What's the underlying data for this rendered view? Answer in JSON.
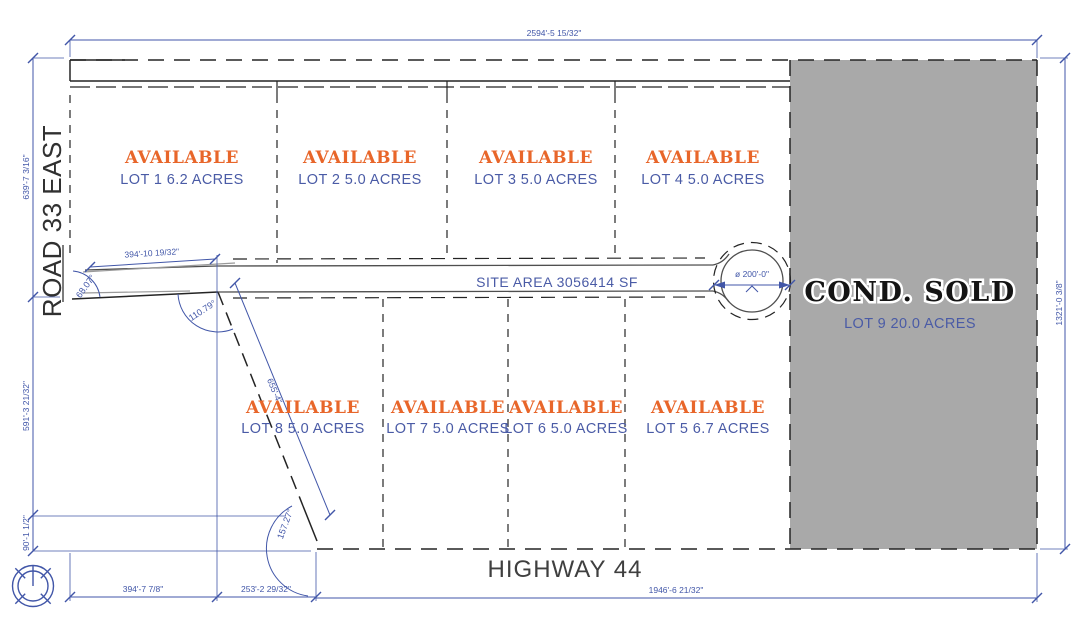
{
  "plan": {
    "site_area_label": "SITE AREA 3056414 SF",
    "roads": {
      "west": "ROAD 33 EAST",
      "south": "HIGHWAY 44"
    },
    "colors": {
      "dimension_blue": "#4156a8",
      "available_orange": "#e8662a",
      "lot_text_blue": "#4a5ba6",
      "sold_gray": "#a9a9a9",
      "line_black": "#242424"
    },
    "lots": [
      {
        "id": "lot-1",
        "status": "AVAILABLE",
        "label": "LOT 1 6.2 ACRES"
      },
      {
        "id": "lot-2",
        "status": "AVAILABLE",
        "label": "LOT 2 5.0 ACRES"
      },
      {
        "id": "lot-3",
        "status": "AVAILABLE",
        "label": "LOT 3 5.0 ACRES"
      },
      {
        "id": "lot-4",
        "status": "AVAILABLE",
        "label": "LOT 4 5.0 ACRES"
      },
      {
        "id": "lot-5",
        "status": "AVAILABLE",
        "label": "LOT 5 6.7 ACRES"
      },
      {
        "id": "lot-6",
        "status": "AVAILABLE",
        "label": "LOT 6 5.0 ACRES"
      },
      {
        "id": "lot-7",
        "status": "AVAILABLE",
        "label": "LOT 7 5.0 ACRES"
      },
      {
        "id": "lot-8",
        "status": "AVAILABLE",
        "label": "LOT 8 5.0 ACRES"
      },
      {
        "id": "lot-9",
        "status": "COND. SOLD",
        "label": "LOT 9 20.0 ACRES"
      }
    ],
    "dimensions": {
      "top": "2594'-5 15/32\"",
      "left_upper": "639'-7 3/16\"",
      "left_middle": "591'-3 21/32\"",
      "left_lower": "90'-1 1/2\"",
      "right": "1321'-0 3/8\"",
      "bottom_west": "394'-7 7/8\"",
      "bottom_center": "253'-2 29/32\"",
      "bottom_east": "1946'-6 21/32\"",
      "road_entry": "394'-10 19/32\"",
      "diagonal": "655'-4\"",
      "culdesac_diameter": "ø 200'-0\""
    },
    "angles": {
      "northwest": "68.07°",
      "road_junction": "110.79°",
      "southwest": "157.27°"
    }
  }
}
